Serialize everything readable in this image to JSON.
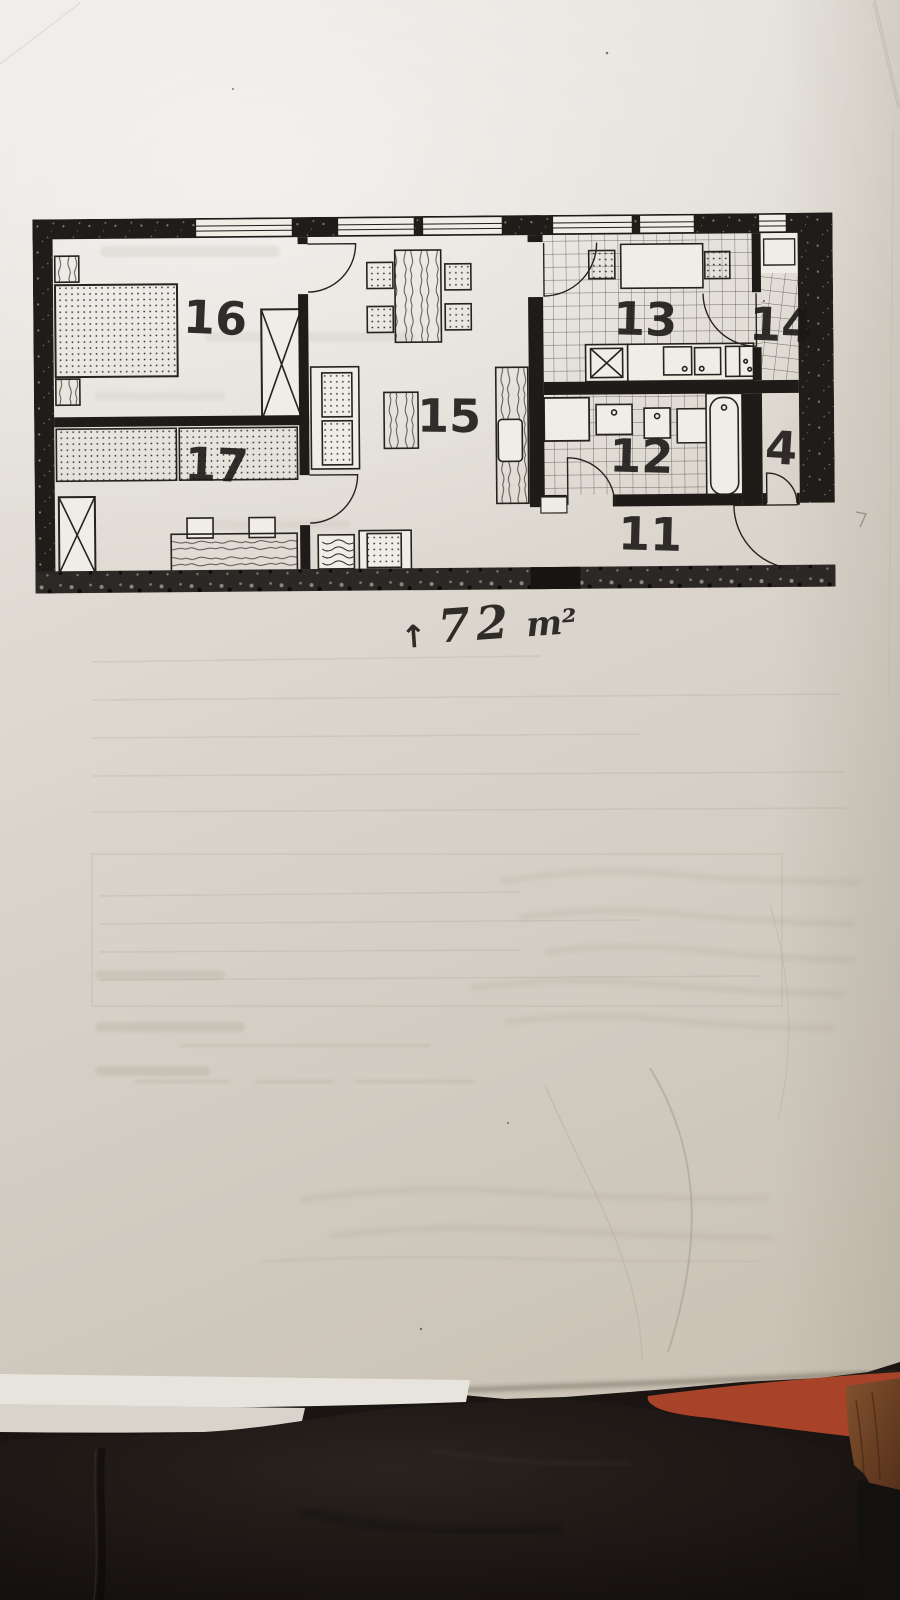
{
  "plan": {
    "rooms": [
      {
        "label": "16"
      },
      {
        "label": "17"
      },
      {
        "label": "15"
      },
      {
        "label": "13"
      },
      {
        "label": "14"
      },
      {
        "label": "12"
      },
      {
        "label": "11"
      },
      {
        "label": "4"
      }
    ],
    "area_note": {
      "arrow": "↑",
      "value": "72",
      "unit": "m²"
    }
  },
  "colors": {
    "paper": "#ded9d1",
    "paper_shadow": "#c8c0b2",
    "ink": "#211e1a",
    "label_ink": "#1b1917",
    "fabric": "#1a1512",
    "folder_orange": "#a8432a",
    "wood_brown": "#7a4a2b"
  }
}
